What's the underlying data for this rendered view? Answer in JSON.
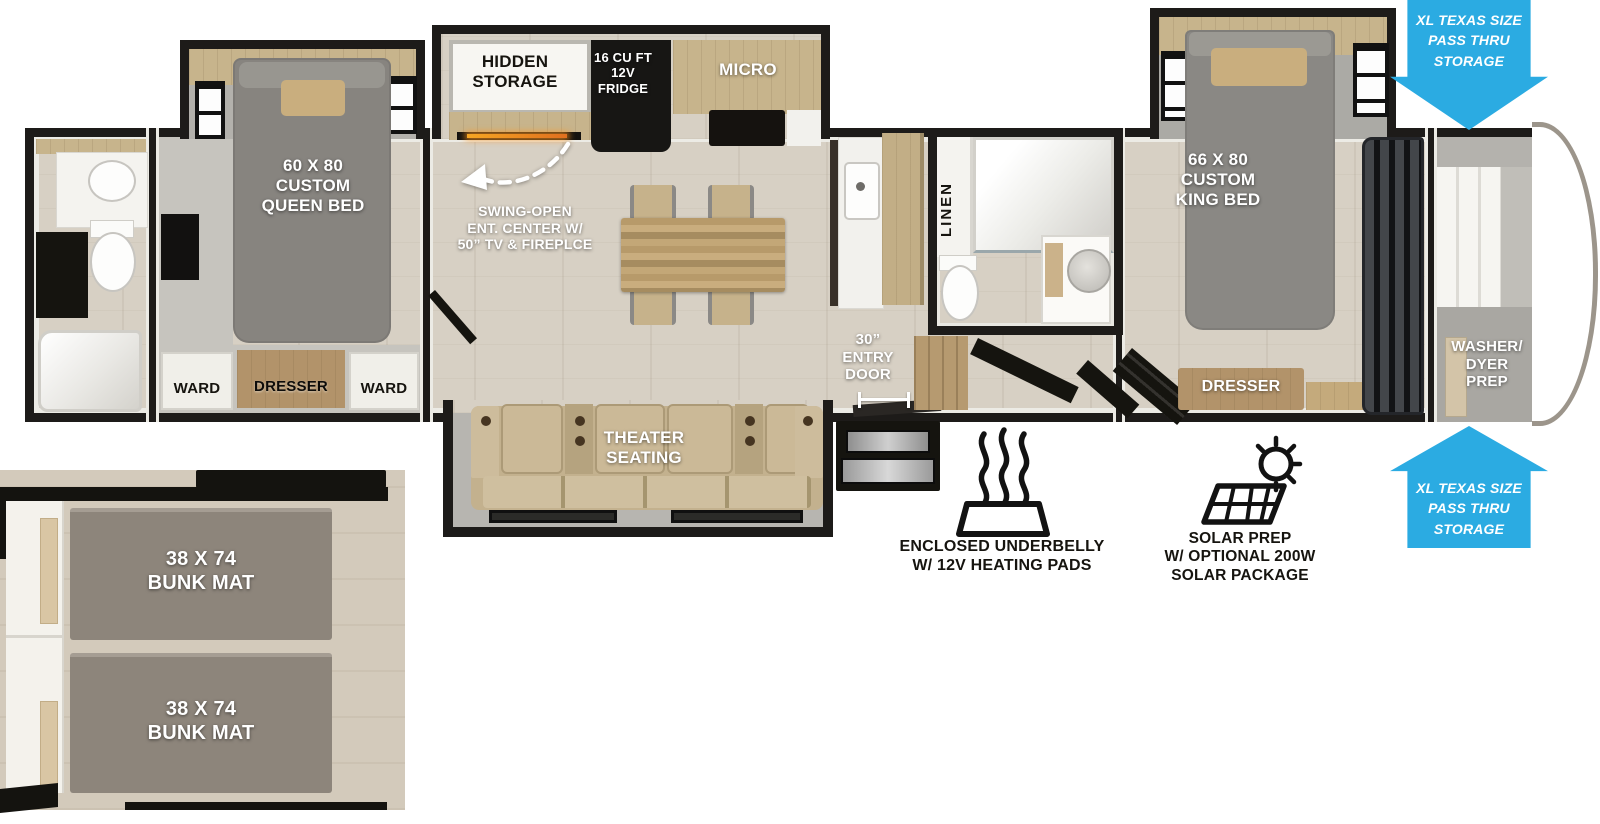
{
  "colors": {
    "arrow_blue": "#2BABE2",
    "wall_black": "#1D1B19",
    "floor_wood": "#D7D0C4",
    "slide_wall": "#B3B1AC",
    "mattress_gray": "#87847F",
    "pillow_tan": "#C9AE7E",
    "sofa_tan": "#C3B18E",
    "counter_wood": "#C7B48C",
    "appliance_black": "#171614",
    "bunk_mat_gray": "#8D857B"
  },
  "plan": {
    "queen_room": {
      "bed_label": "60 X 80\nCUSTOM\nQUEEN BED",
      "ward_left": "WARD",
      "dresser": "DRESSER",
      "ward_right": "WARD"
    },
    "kitchen": {
      "hidden_storage": "HIDDEN\nSTORAGE",
      "fridge": "16 CU FT\n12V\nFRIDGE",
      "micro": "MICRO",
      "ent_center_note": "SWING-OPEN\nENT. CENTER W/\n50” TV & FIREPLCE"
    },
    "living": {
      "theater_seating": "THEATER\nSEATING",
      "entry_door": "30”\nENTRY\nDOOR"
    },
    "mid_bath": {
      "linen": "LINEN"
    },
    "king_room": {
      "bed_label": "66 X 80\nCUSTOM\nKING BED",
      "dresser": "DRESSER"
    },
    "front": {
      "washer_dryer": "WASHER/\nDYER\nPREP"
    }
  },
  "callouts": {
    "pass_thru_top": "XL TEXAS SIZE\nPASS THRU\nSTORAGE",
    "pass_thru_bottom": "XL TEXAS SIZE\nPASS THRU\nSTORAGE",
    "underbelly": "ENCLOSED UNDERBELLY\nW/ 12V HEATING PADS",
    "solar": "SOLAR PREP\nW/ OPTIONAL 200W\nSOLAR PACKAGE"
  },
  "bunk_inset": {
    "top_bunk": "38 X 74\nBUNK MAT",
    "bottom_bunk": "38 X 74\nBUNK MAT"
  }
}
